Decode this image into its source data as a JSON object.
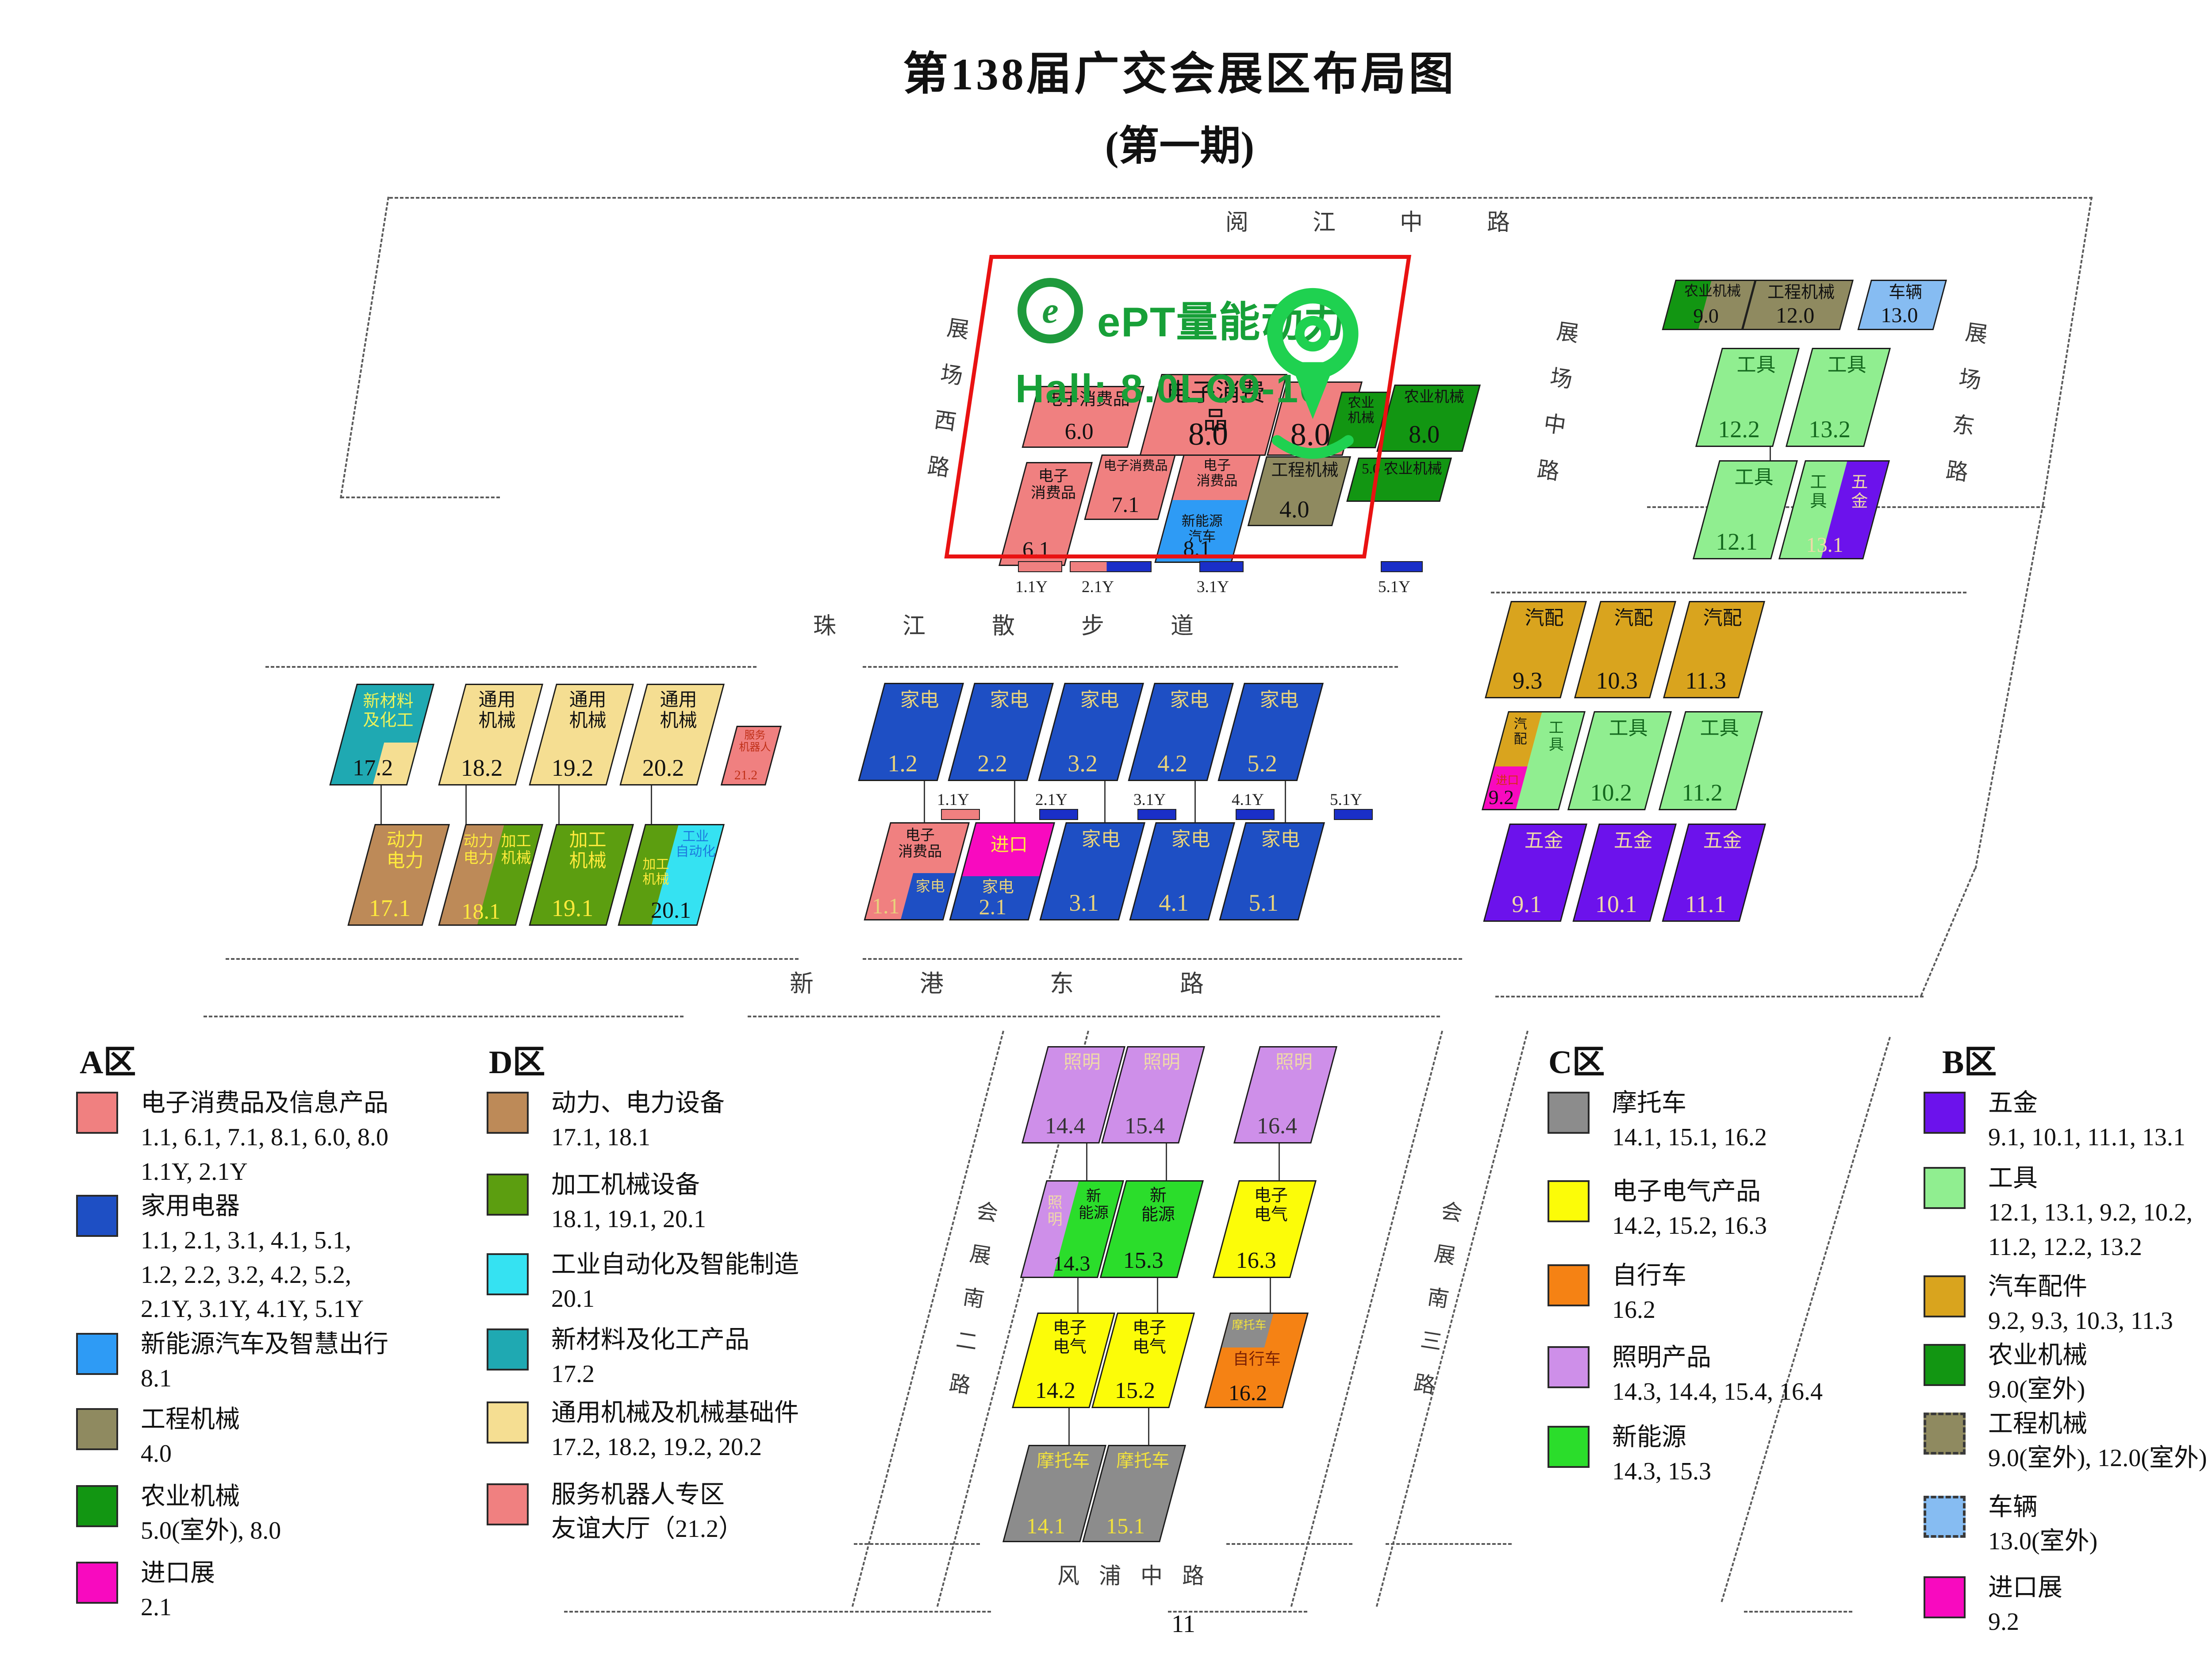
{
  "title": {
    "line1": "第138届广交会展区布局图",
    "line2": "(第一期)"
  },
  "page_number": "11",
  "overlay": {
    "brand_e": "e",
    "brand_text": "ePT量能动力",
    "hall_text": "Hall: 8.0LO9-10",
    "accent_green": "#17A038",
    "box_red": "#E91212",
    "pin_green": "#1FD150"
  },
  "colors": {
    "salmon": "#F08080",
    "blue": "#1E4FC4",
    "dodger": "#2E9BF5",
    "olivekhaki": "#8F8A60",
    "forest": "#129612",
    "lightgreen": "#90EE90",
    "purple": "#6C12EC",
    "goldenrod": "#D9A41E",
    "wheat": "#F5DE92",
    "brown": "#BD8A58",
    "dgreen": "#5C9E10",
    "cyan": "#35E2F2",
    "teal": "#1FA9B2",
    "plum": "#CE8FE9",
    "bgreen": "#2BDD2B",
    "yellow": "#FCFC08",
    "gray": "#8C8C8C",
    "orange": "#F58214",
    "ltblue": "#86BCF2",
    "magenta": "#F80ABF",
    "royal": "#1A2FC8"
  },
  "roads": [
    {
      "id": "yuejiang",
      "label": "阅江中路"
    },
    {
      "id": "west",
      "label": "展场西路"
    },
    {
      "id": "mid",
      "label": "展场中路"
    },
    {
      "id": "east",
      "label": "展场东路"
    },
    {
      "id": "zhujiang",
      "label": "珠江散步道"
    },
    {
      "id": "xingang",
      "label": "新港东路"
    },
    {
      "id": "south2",
      "label": "会展南二路"
    },
    {
      "id": "south3",
      "label": "会展南三路"
    },
    {
      "id": "fengpu",
      "label": "风浦中路"
    }
  ],
  "halls": [
    {
      "id": "6.0",
      "cat": "salmon",
      "name": "电子消费品",
      "num": "6.0"
    },
    {
      "id": "8.0a",
      "cat": "salmon",
      "name": "电子消费品",
      "num": "8.0"
    },
    {
      "id": "8.0b",
      "cat": "salmon",
      "name": "",
      "num": "8.0"
    },
    {
      "id": "njx",
      "cat": "forest",
      "name": "农业\n机械",
      "num": ""
    },
    {
      "id": "8.0c",
      "cat": "forest",
      "name": "农业机械",
      "num": "8.0"
    },
    {
      "id": "6.1",
      "cat": "salmon",
      "name": "电子\n消费品",
      "num": "6.1"
    },
    {
      "id": "7.1",
      "cat": "salmon",
      "name": "电子消费品",
      "num": "7.1"
    },
    {
      "id": "8.1",
      "cat": "salmon",
      "name": "电子\n消费品",
      "num": "8.1",
      "parts": [
        {
          "cat": "dodger",
          "text": "新能源\n汽车",
          "fg": "#111111"
        }
      ]
    },
    {
      "id": "4.0",
      "cat": "olivekhaki",
      "name": "工程机械",
      "num": "4.0"
    },
    {
      "id": "5.0",
      "cat": "forest",
      "name": "5.0 农业机械",
      "num": ""
    },
    {
      "id": "9.0",
      "cat": "olivekhaki",
      "name": "农业机械",
      "num": "9.0",
      "parts": [
        {
          "cat": "forest",
          "text": "",
          "fg": ""
        }
      ]
    },
    {
      "id": "12.0",
      "cat": "olivekhaki",
      "name": "工程机械",
      "num": "12.0"
    },
    {
      "id": "13.0",
      "cat": "ltblue",
      "name": "车辆",
      "num": "13.0"
    },
    {
      "id": "12.2",
      "cat": "lightgreen",
      "fg": "#14691E",
      "numColor": "#14691E",
      "name": "工具",
      "num": "12.2"
    },
    {
      "id": "13.2",
      "cat": "lightgreen",
      "fg": "#14691E",
      "numColor": "#14691E",
      "name": "工具",
      "num": "13.2"
    },
    {
      "id": "12.1",
      "cat": "lightgreen",
      "fg": "#14691E",
      "numColor": "#14691E",
      "name": "工具",
      "num": "12.1"
    },
    {
      "id": "13.1",
      "cat": "lightgreen",
      "fg": "#14691E",
      "numColor": "#EFD9A8",
      "name": "工\n具",
      "num": "13.1",
      "parts": [
        {
          "cat": "purple",
          "text": "五\n金",
          "fg": "#EFD9A8"
        }
      ]
    },
    {
      "id": "17.2",
      "cat": "teal",
      "fg": "#ECF25A",
      "numColor": "#111111",
      "name": "新材料\n及化工",
      "num": "17.2",
      "parts": [
        {
          "cat": "wheat",
          "text": "",
          "fg": ""
        }
      ]
    },
    {
      "id": "18.2",
      "cat": "wheat",
      "name": "通用\n机械",
      "num": "18.2"
    },
    {
      "id": "19.2",
      "cat": "wheat",
      "name": "通用\n机械",
      "num": "19.2"
    },
    {
      "id": "20.2",
      "cat": "wheat",
      "name": "通用\n机械",
      "num": "20.2"
    },
    {
      "id": "21.2",
      "cat": "salmon",
      "fg": "#C03018",
      "numColor": "#C03018",
      "name": "服务\n机器人",
      "num": "21.2"
    },
    {
      "id": "17.1",
      "cat": "brown",
      "fg": "#FFEB3C",
      "numColor": "#FFEB3C",
      "name": "动力\n电力",
      "num": "17.1"
    },
    {
      "id": "18.1",
      "cat": "brown",
      "fg": "#FFEB3C",
      "numColor": "#FFEB3C",
      "name": "动力\n电力",
      "num": "18.1",
      "parts": [
        {
          "cat": "dgreen",
          "text": "加工\n机械",
          "fg": "#FFEB3C"
        }
      ]
    },
    {
      "id": "19.1",
      "cat": "dgreen",
      "fg": "#FFEB3C",
      "numColor": "#FFEB3C",
      "name": "加工\n机械",
      "num": "19.1"
    },
    {
      "id": "20.1",
      "cat": "dgreen",
      "fg": "#FFEB3C",
      "numColor": "#111111",
      "name": "加工\n机械",
      "num": "20.1",
      "parts": [
        {
          "cat": "cyan",
          "text": "工业\n自动化",
          "fg": "#1C79DE"
        }
      ]
    },
    {
      "id": "1.2",
      "cat": "blue",
      "fg": "#E8D27C",
      "name": "家电",
      "num": "1.2"
    },
    {
      "id": "2.2",
      "cat": "blue",
      "fg": "#E8D27C",
      "name": "家电",
      "num": "2.2"
    },
    {
      "id": "3.2",
      "cat": "blue",
      "fg": "#E8D27C",
      "name": "家电",
      "num": "3.2"
    },
    {
      "id": "4.2",
      "cat": "blue",
      "fg": "#E8D27C",
      "name": "家电",
      "num": "4.2"
    },
    {
      "id": "5.2",
      "cat": "blue",
      "fg": "#E8D27C",
      "name": "家电",
      "num": "5.2"
    },
    {
      "id": "1.1",
      "cat": "salmon",
      "numColor": "#E8D27C",
      "name": "电子\n消费品",
      "num": "1.1",
      "parts": [
        {
          "cat": "blue",
          "text": "家电",
          "fg": "#E8D27C"
        }
      ]
    },
    {
      "id": "2.1",
      "cat": "blue",
      "fg": "#E8D27C",
      "numColor": "#E8D27C",
      "name": "家电",
      "num": "2.1",
      "parts": [
        {
          "cat": "magenta",
          "text": "进口",
          "fg": "#FFEB3C"
        }
      ]
    },
    {
      "id": "3.1",
      "cat": "blue",
      "fg": "#E8D27C",
      "name": "家电",
      "num": "3.1"
    },
    {
      "id": "4.1",
      "cat": "blue",
      "fg": "#E8D27C",
      "name": "家电",
      "num": "4.1"
    },
    {
      "id": "5.1",
      "cat": "blue",
      "fg": "#E8D27C",
      "name": "家电",
      "num": "5.1"
    },
    {
      "id": "9.3",
      "cat": "goldenrod",
      "name": "汽配",
      "num": "9.3"
    },
    {
      "id": "10.3",
      "cat": "goldenrod",
      "name": "汽配",
      "num": "10.3"
    },
    {
      "id": "11.3",
      "cat": "goldenrod",
      "name": "汽配",
      "num": "11.3"
    },
    {
      "id": "9.2",
      "cat": "lightgreen",
      "fg": "#14691E",
      "numColor": "#111111",
      "name": "工\n具",
      "num": "9.2",
      "parts": [
        {
          "cat": "goldenrod",
          "text": "汽\n配",
          "fg": "#111111"
        },
        {
          "cat": "magenta",
          "text": "进口",
          "fg": "#D33010"
        }
      ]
    },
    {
      "id": "10.2",
      "cat": "lightgreen",
      "fg": "#14691E",
      "numColor": "#14691E",
      "name": "工具",
      "num": "10.2"
    },
    {
      "id": "11.2",
      "cat": "lightgreen",
      "fg": "#14691E",
      "numColor": "#14691E",
      "name": "工具",
      "num": "11.2"
    },
    {
      "id": "9.1",
      "cat": "purple",
      "fg": "#EFD9A8",
      "numColor": "#EFD9A8",
      "name": "五金",
      "num": "9.1"
    },
    {
      "id": "10.1",
      "cat": "purple",
      "fg": "#EFD9A8",
      "numColor": "#EFD9A8",
      "name": "五金",
      "num": "10.1"
    },
    {
      "id": "11.1",
      "cat": "purple",
      "fg": "#EFD9A8",
      "numColor": "#EFD9A8",
      "name": "五金",
      "num": "11.1"
    },
    {
      "id": "14.4",
      "cat": "plum",
      "fg": "#EFD9A8",
      "numColor": "#333333",
      "name": "照明",
      "num": "14.4"
    },
    {
      "id": "15.4",
      "cat": "plum",
      "fg": "#EFD9A8",
      "numColor": "#333333",
      "name": "照明",
      "num": "15.4"
    },
    {
      "id": "16.4",
      "cat": "plum",
      "fg": "#EFD9A8",
      "numColor": "#333333",
      "name": "照明",
      "num": "16.4"
    },
    {
      "id": "14.3",
      "cat": "bgreen",
      "numColor": "#111111",
      "name": "新\n能源",
      "num": "14.3",
      "parts": [
        {
          "cat": "plum",
          "text": "照\n明",
          "fg": "#EFD9A8"
        }
      ]
    },
    {
      "id": "15.3",
      "cat": "bgreen",
      "name": "新\n能源",
      "num": "15.3"
    },
    {
      "id": "16.3",
      "cat": "yellow",
      "name": "电子\n电气",
      "num": "16.3"
    },
    {
      "id": "14.2",
      "cat": "yellow",
      "name": "电子\n电气",
      "num": "14.2"
    },
    {
      "id": "15.2",
      "cat": "yellow",
      "name": "电子\n电气",
      "num": "15.2"
    },
    {
      "id": "16.2",
      "cat": "orange",
      "fg": "#7A2004",
      "numColor": "#111111",
      "name": "自行车",
      "num": "16.2",
      "parts": [
        {
          "cat": "gray",
          "text": "摩托车",
          "fg": "#F2E23C"
        }
      ]
    },
    {
      "id": "14.1",
      "cat": "gray",
      "fg": "#F2E23C",
      "numColor": "#F2E23C",
      "name": "摩托车",
      "num": "14.1"
    },
    {
      "id": "15.1",
      "cat": "gray",
      "fg": "#F2E23C",
      "numColor": "#F2E23C",
      "name": "摩托车",
      "num": "15.1"
    }
  ],
  "y_markers": [
    {
      "id": "t1",
      "label": "1.1Y",
      "bars": [
        "salmon"
      ]
    },
    {
      "id": "t2",
      "label": "2.1Y",
      "bars": [
        "salmon",
        "royal"
      ]
    },
    {
      "id": "t3",
      "label": "3.1Y",
      "bars": [
        "royal"
      ]
    },
    {
      "id": "t5",
      "label": "5.1Y",
      "bars": [
        "royal"
      ]
    },
    {
      "id": "m1",
      "label": "1.1Y",
      "bars": [
        "salmon"
      ]
    },
    {
      "id": "m2",
      "label": "2.1Y",
      "bars": [
        "royal"
      ]
    },
    {
      "id": "m3",
      "label": "3.1Y",
      "bars": [
        "royal"
      ]
    },
    {
      "id": "m4",
      "label": "4.1Y",
      "bars": [
        "royal"
      ]
    },
    {
      "id": "m5",
      "label": "5.1Y",
      "bars": [
        "royal"
      ]
    }
  ],
  "legends": [
    {
      "id": "A",
      "title": "A区",
      "items": [
        {
          "color": "salmon",
          "lines": [
            "电子消费品及信息产品",
            "1.1, 6.1, 7.1, 8.1, 6.0, 8.0",
            "1.1Y, 2.1Y"
          ]
        },
        {
          "color": "blue",
          "lines": [
            "家用电器",
            "1.1, 2.1, 3.1, 4.1, 5.1,",
            "1.2, 2.2, 3.2, 4.2, 5.2,",
            "2.1Y, 3.1Y, 4.1Y, 5.1Y"
          ]
        },
        {
          "color": "dodger",
          "lines": [
            "新能源汽车及智慧出行",
            "8.1"
          ]
        },
        {
          "color": "olivekhaki",
          "lines": [
            "工程机械",
            "4.0"
          ]
        },
        {
          "color": "forest",
          "lines": [
            "农业机械",
            "5.0(室外), 8.0"
          ]
        },
        {
          "color": "magenta",
          "lines": [
            "进口展",
            "2.1"
          ]
        }
      ]
    },
    {
      "id": "D",
      "title": "D区",
      "items": [
        {
          "color": "brown",
          "lines": [
            "动力、电力设备",
            "17.1, 18.1"
          ]
        },
        {
          "color": "dgreen",
          "lines": [
            "加工机械设备",
            "18.1, 19.1, 20.1"
          ]
        },
        {
          "color": "cyan",
          "lines": [
            "工业自动化及智能制造",
            "20.1"
          ]
        },
        {
          "color": "teal",
          "lines": [
            "新材料及化工产品",
            "17.2"
          ]
        },
        {
          "color": "wheat",
          "lines": [
            "通用机械及机械基础件",
            "17.2, 18.2, 19.2, 20.2"
          ]
        },
        {
          "color": "salmon",
          "lines": [
            "服务机器人专区",
            "友谊大厅（21.2）"
          ]
        }
      ]
    },
    {
      "id": "C",
      "title": "C区",
      "items": [
        {
          "color": "gray",
          "lines": [
            "摩托车",
            "14.1, 15.1, 16.2"
          ]
        },
        {
          "color": "yellow",
          "lines": [
            "电子电气产品",
            "14.2, 15.2, 16.3"
          ]
        },
        {
          "color": "orange",
          "lines": [
            "自行车",
            "16.2"
          ]
        },
        {
          "color": "plum",
          "lines": [
            "照明产品",
            "14.3, 14.4, 15.4, 16.4"
          ]
        },
        {
          "color": "bgreen",
          "lines": [
            "新能源",
            "14.3, 15.3"
          ]
        }
      ]
    },
    {
      "id": "B",
      "title": "B区",
      "items": [
        {
          "color": "purple",
          "lines": [
            "五金",
            "9.1, 10.1, 11.1, 13.1"
          ]
        },
        {
          "color": "lightgreen",
          "lines": [
            "工具",
            "12.1, 13.1, 9.2, 10.2,",
            "11.2, 12.2, 13.2"
          ]
        },
        {
          "color": "goldenrod",
          "lines": [
            "汽车配件",
            "9.2, 9.3, 10.3, 11.3"
          ]
        },
        {
          "color": "forest",
          "lines": [
            "农业机械",
            "9.0(室外)"
          ]
        },
        {
          "color": "olivekhaki",
          "dashed": true,
          "lines": [
            "工程机械",
            "9.0(室外), 12.0(室外)"
          ]
        },
        {
          "color": "ltblue",
          "dashed": true,
          "lines": [
            "车辆",
            "13.0(室外)"
          ]
        },
        {
          "color": "magenta",
          "lines": [
            "进口展",
            "9.2"
          ]
        }
      ]
    }
  ]
}
